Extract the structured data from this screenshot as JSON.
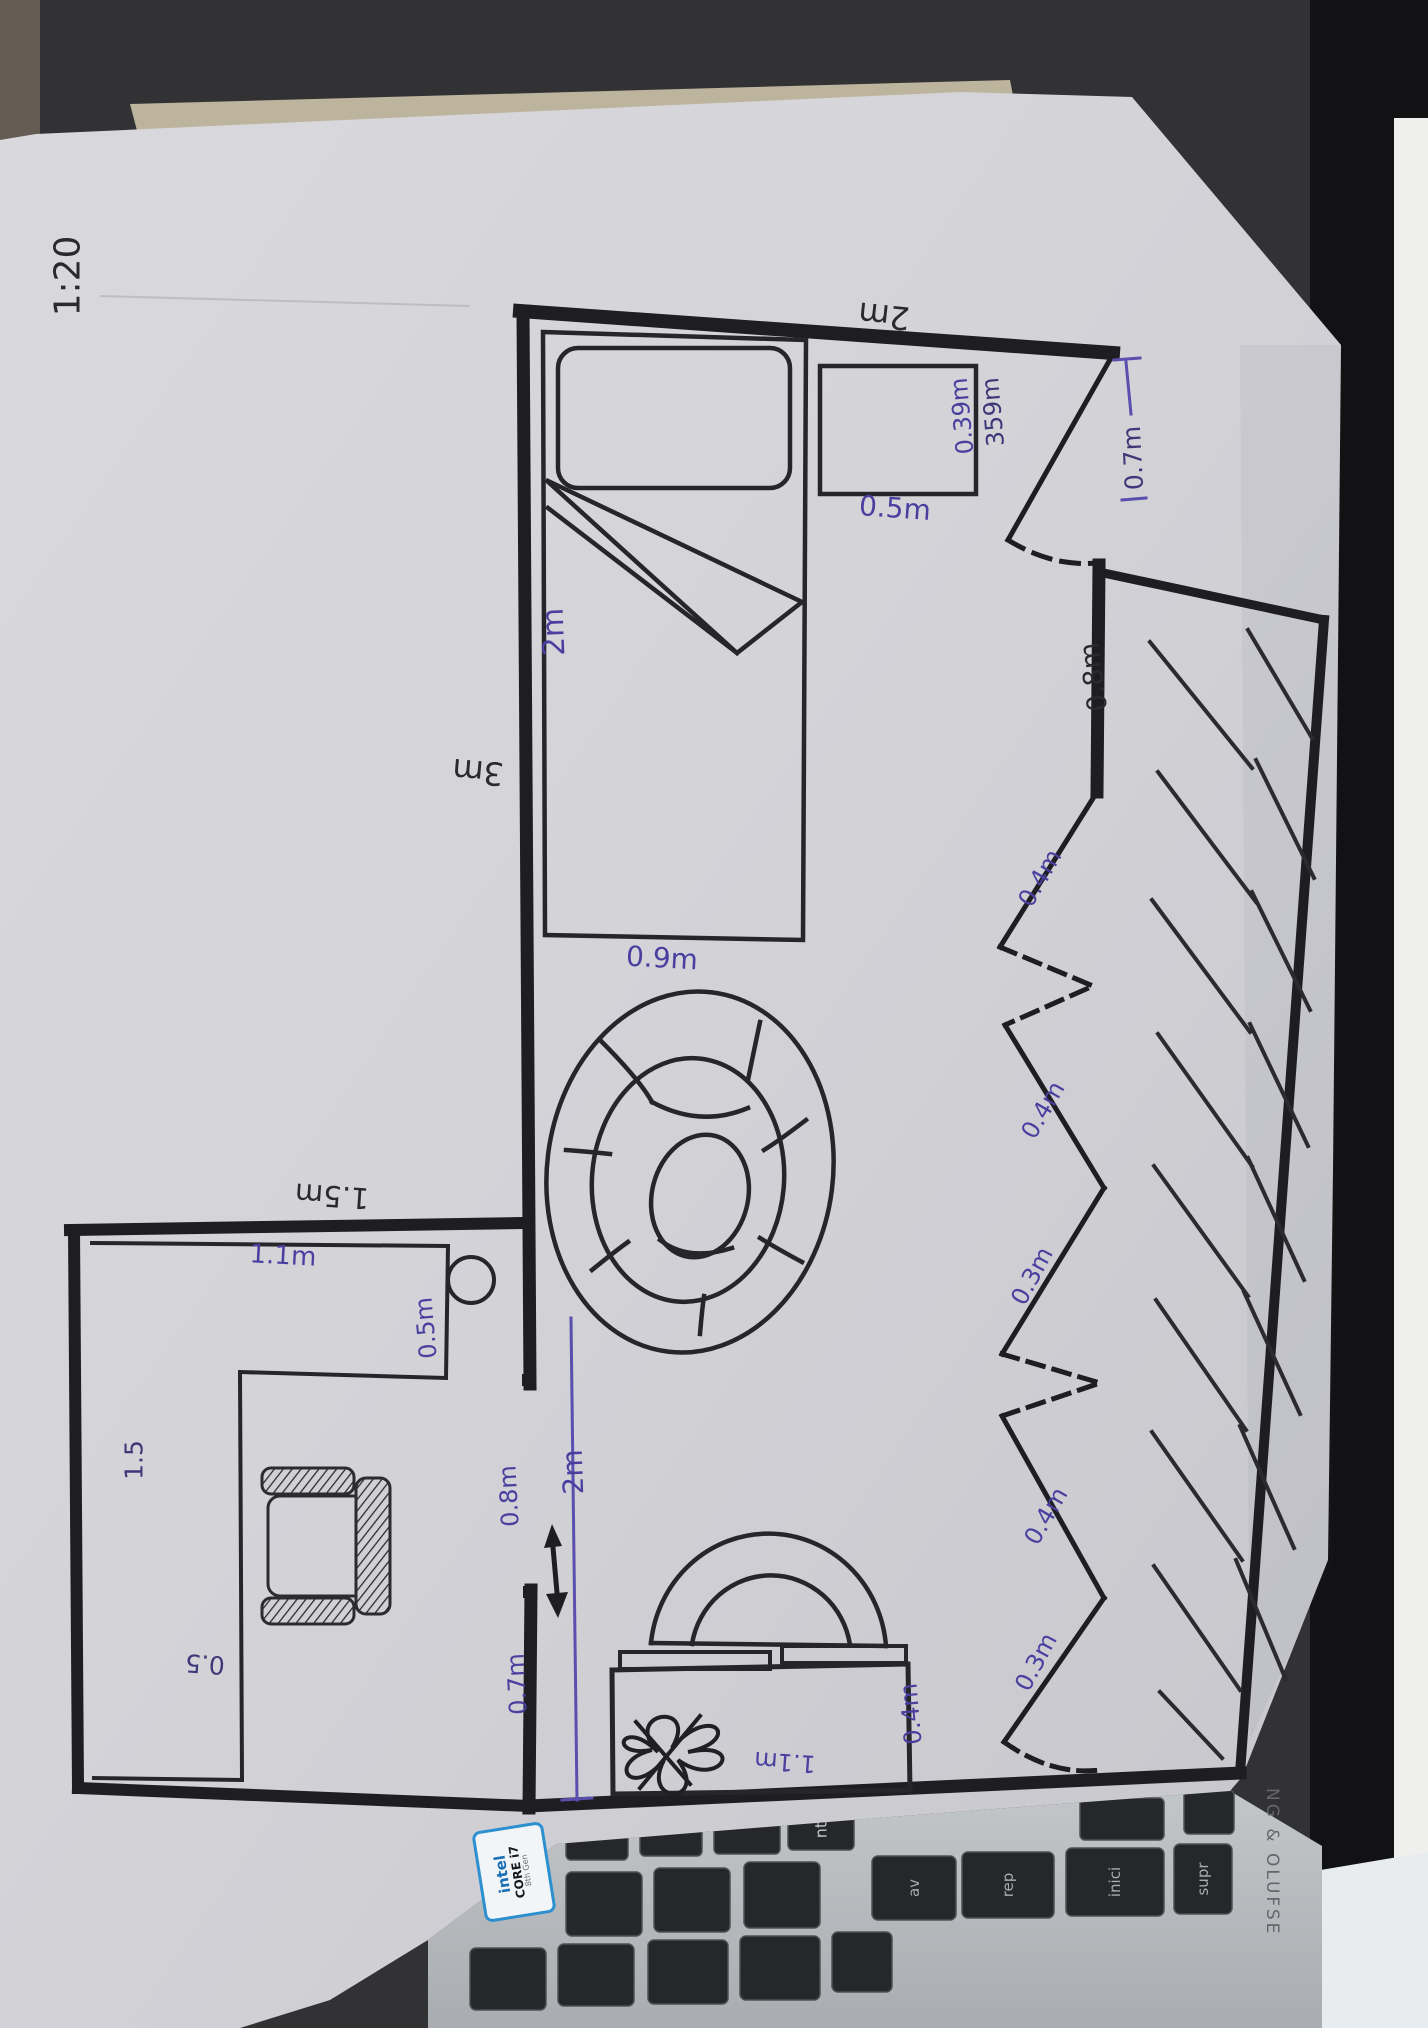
{
  "drawing": {
    "scale_note": "1:20",
    "dimensions": {
      "top_wall": "2m",
      "left_wall": "3m",
      "bed_length": "2m",
      "bed_width": "0.9m",
      "nightstand_width": "0.5m",
      "nightstand_depth": "0.39m",
      "nightstand_depth_alt": "359m",
      "entry_door_width": "0.7m",
      "right_wall_segment": "0.8m",
      "closet_panel_1": "0.4m",
      "closet_panel_2": "0.4m",
      "closet_panel_3": "0.3m",
      "closet_panel_4": "0.4m",
      "closet_panel_5": "0.3m",
      "desk_room_width": "1.5m",
      "desk_width": "1.1m",
      "desk_depth": "0.5m",
      "desk_side_length": "1.5",
      "desk_side_depth": "0.5",
      "left_opening_wall_upper": "0.8m",
      "left_opening_total": "2m",
      "left_opening_wall_lower": "0.7m",
      "dresser_width": "1.1m",
      "dresser_depth": "0.4m"
    }
  },
  "laptop": {
    "brand_text": "NG & OLUFSE",
    "keys": {
      "enter": "nt",
      "av_pag": "av",
      "re_pag": "rep",
      "inicio": "inici",
      "supr": "supr"
    },
    "sticker": {
      "brand": "intel",
      "line1": "CORE i7",
      "line2": "8th Gen"
    }
  }
}
